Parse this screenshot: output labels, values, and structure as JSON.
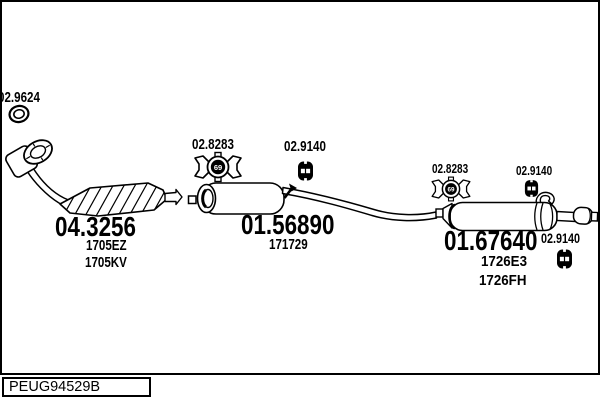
{
  "colors": {
    "ink": "#000000",
    "background": "#ffffff"
  },
  "footer": {
    "code": "PEUG94529B"
  },
  "parts": {
    "front_gasket": {
      "number": "02.9624"
    },
    "catalyst": {
      "number": "04.3256",
      "refs": [
        "1705EZ",
        "1705KV"
      ]
    },
    "clamp_front": {
      "number": "02.8283",
      "size": "69"
    },
    "hanger_mid": {
      "number": "02.9140"
    },
    "mid_muffler": {
      "number": "01.56890",
      "refs": [
        "171729"
      ]
    },
    "clamp_rear": {
      "number": "02.8283",
      "size": "69"
    },
    "hanger_rear": {
      "number": "02.9140"
    },
    "rear_muffler": {
      "number": "01.67640",
      "refs": [
        "1726E3",
        "1726FH"
      ]
    },
    "hanger_tail": {
      "number": "02.9140"
    }
  },
  "icons": {
    "gasket": "double-ring",
    "clamp": "bowtie-clamp-with-size",
    "hanger": "rubber-mount-two-holes"
  }
}
